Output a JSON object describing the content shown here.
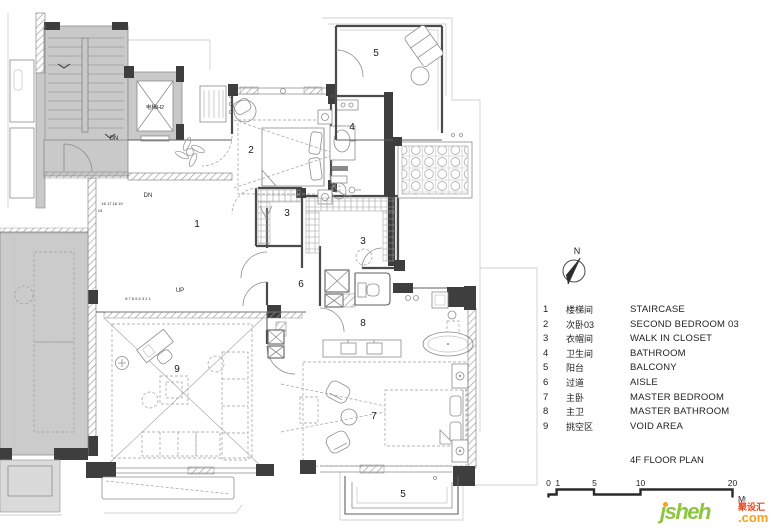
{
  "plan": {
    "labels": [
      {
        "text": "1",
        "x": 197,
        "y": 227
      },
      {
        "text": "2",
        "x": 251,
        "y": 153
      },
      {
        "text": "3",
        "x": 287,
        "y": 216
      },
      {
        "text": "3",
        "x": 363,
        "y": 244
      },
      {
        "text": "4",
        "x": 352,
        "y": 130
      },
      {
        "text": "5",
        "x": 376,
        "y": 56
      },
      {
        "text": "5",
        "x": 403,
        "y": 497
      },
      {
        "text": "6",
        "x": 301,
        "y": 287
      },
      {
        "text": "7",
        "x": 374,
        "y": 419
      },
      {
        "text": "8",
        "x": 363,
        "y": 326
      },
      {
        "text": "9",
        "x": 177,
        "y": 372
      }
    ],
    "annotations": [
      {
        "text": "电梯H2",
        "x": 155,
        "y": 109,
        "size": 5.5
      },
      {
        "text": "DN",
        "x": 114,
        "y": 140,
        "size": 6
      },
      {
        "text": "DN",
        "x": 148,
        "y": 197,
        "size": 6
      },
      {
        "text": "UP",
        "x": 180,
        "y": 292,
        "size": 6
      },
      {
        "text": "16 17 18 19",
        "x": 112,
        "y": 205,
        "size": 4
      },
      {
        "text": "15",
        "x": 100,
        "y": 212,
        "size": 4
      },
      {
        "text": "8 7 6 5 4 3 2 1",
        "x": 138,
        "y": 300,
        "size": 4
      }
    ]
  },
  "north": {
    "label": "N"
  },
  "legend": {
    "items": [
      {
        "num": "1",
        "zh": "楼梯间",
        "en": "STAIRCASE"
      },
      {
        "num": "2",
        "zh": "次卧03",
        "en": "SECOND BEDROOM 03"
      },
      {
        "num": "3",
        "zh": "衣帽间",
        "en": "WALK IN CLOSET"
      },
      {
        "num": "4",
        "zh": "卫生间",
        "en": "BATHROOM"
      },
      {
        "num": "5",
        "zh": "阳台",
        "en": "BALCONY"
      },
      {
        "num": "6",
        "zh": "过道",
        "en": "AISLE"
      },
      {
        "num": "7",
        "zh": "主卧",
        "en": "MASTER BEDROOM"
      },
      {
        "num": "8",
        "zh": "主卫",
        "en": "MASTER BATHROOM"
      },
      {
        "num": "9",
        "zh": "挑空区",
        "en": "VOID AREA"
      }
    ],
    "title": "4F FLOOR PLAN"
  },
  "scale": {
    "ticks": [
      {
        "label": "0",
        "m": 0
      },
      {
        "label": "1",
        "m": 1
      },
      {
        "label": "5",
        "m": 5
      },
      {
        "label": "10",
        "m": 10
      },
      {
        "label": "20",
        "m": 20
      }
    ],
    "unit": "M"
  },
  "logo": {
    "name": "jsheh",
    "tm": "TM",
    "zh": "聚设汇",
    "com": ".com"
  },
  "colors": {
    "wall": "#3e3e3e",
    "common_area": "#c9c9c9",
    "logo_green": "#8cc63e",
    "logo_orange": "#f5a11c",
    "logo_red": "#e8471d"
  }
}
